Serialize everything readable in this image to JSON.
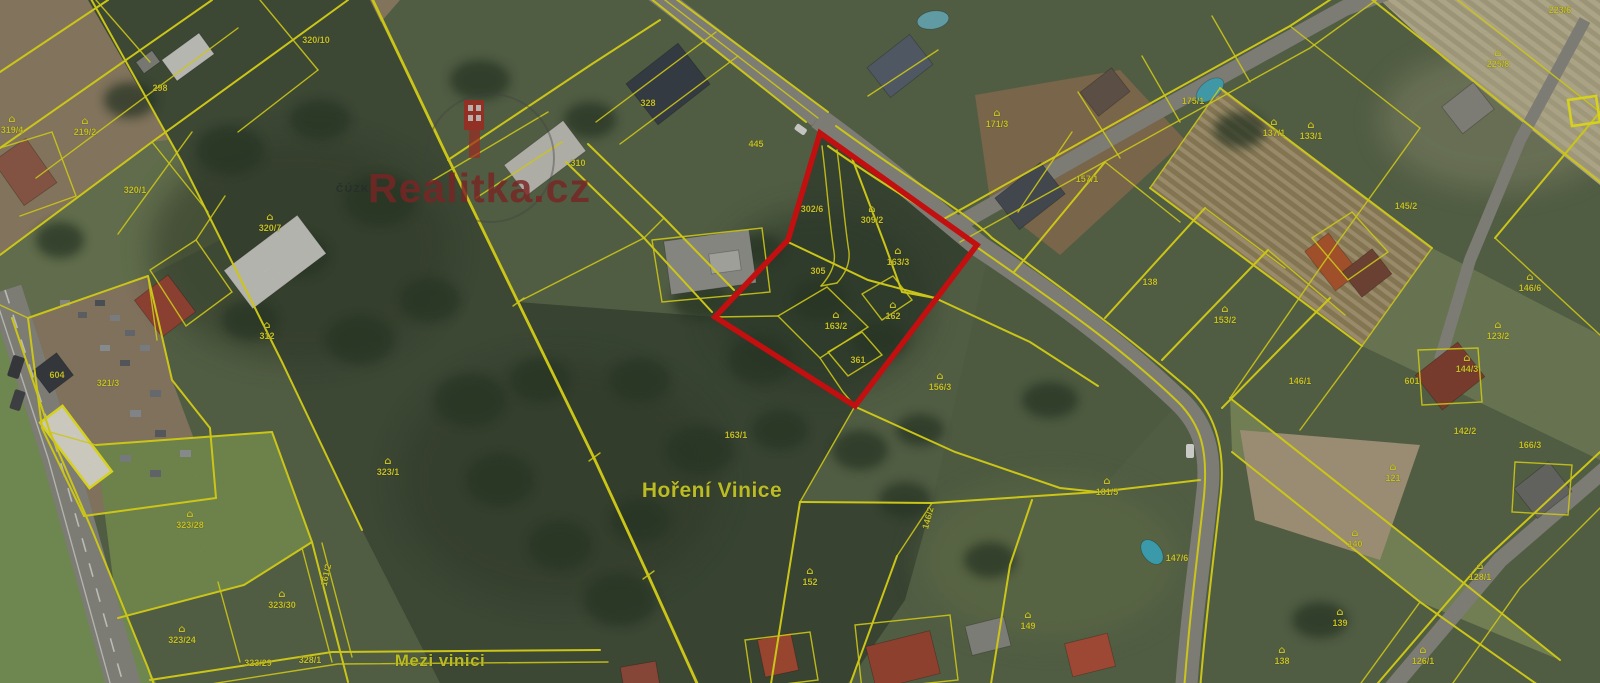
{
  "map": {
    "attribution": "ČÚZK",
    "watermark": {
      "brand": "Realitka.cz"
    },
    "place_labels": [
      {
        "text": "Hoření Vinice",
        "x": 712,
        "y": 497,
        "size": 21
      },
      {
        "text": "Mezi vinici",
        "x": 440,
        "y": 666,
        "size": 17
      }
    ],
    "colors": {
      "boundary": "#ebe41c",
      "highlight": "#e01212",
      "label": "#e3dc2c",
      "watermark": "#8d2b2b",
      "road": "#8f8f88"
    },
    "highlighted_parcel": {
      "description": "Parcel group outlined in red",
      "parcels": [
        "302/6",
        "309/2",
        "305",
        "163/3",
        "163/2",
        "361",
        "162"
      ]
    },
    "parcel_labels": [
      {
        "n": "320/10",
        "x": 316,
        "y": 40
      },
      {
        "n": "298",
        "x": 160,
        "y": 88
      },
      {
        "n": "319/4",
        "x": 12,
        "y": 130,
        "icon": true
      },
      {
        "n": "219/2",
        "x": 85,
        "y": 132,
        "icon": true
      },
      {
        "n": "320/1",
        "x": 135,
        "y": 190
      },
      {
        "n": "320/7",
        "x": 270,
        "y": 228,
        "icon": true
      },
      {
        "n": "312",
        "x": 267,
        "y": 336,
        "icon": true
      },
      {
        "n": "321/3",
        "x": 108,
        "y": 383
      },
      {
        "n": "604",
        "x": 57,
        "y": 375
      },
      {
        "n": "323/1",
        "x": 388,
        "y": 472,
        "icon": true
      },
      {
        "n": "323/28",
        "x": 190,
        "y": 525,
        "icon": true
      },
      {
        "n": "323/30",
        "x": 282,
        "y": 605,
        "icon": true
      },
      {
        "n": "323/24",
        "x": 182,
        "y": 640,
        "icon": true
      },
      {
        "n": "323/29",
        "x": 258,
        "y": 663
      },
      {
        "n": "328/1",
        "x": 310,
        "y": 660
      },
      {
        "n": "161/2",
        "x": 326,
        "y": 575,
        "rot": -78
      },
      {
        "n": "328",
        "x": 648,
        "y": 103
      },
      {
        "n": "310",
        "x": 578,
        "y": 163
      },
      {
        "n": "445",
        "x": 756,
        "y": 144
      },
      {
        "n": "302/6",
        "x": 812,
        "y": 209
      },
      {
        "n": "309/2",
        "x": 872,
        "y": 220,
        "icon": true
      },
      {
        "n": "305",
        "x": 818,
        "y": 271
      },
      {
        "n": "163/3",
        "x": 898,
        "y": 262,
        "icon": true
      },
      {
        "n": "163/2",
        "x": 836,
        "y": 326,
        "icon": true
      },
      {
        "n": "361",
        "x": 858,
        "y": 360
      },
      {
        "n": "162",
        "x": 893,
        "y": 316,
        "icon": true
      },
      {
        "n": "156/3",
        "x": 940,
        "y": 387,
        "icon": true
      },
      {
        "n": "163/1",
        "x": 736,
        "y": 435
      },
      {
        "n": "152",
        "x": 810,
        "y": 582,
        "icon": true
      },
      {
        "n": "149",
        "x": 1028,
        "y": 626,
        "icon": true
      },
      {
        "n": "146/2",
        "x": 928,
        "y": 518,
        "rot": -75
      },
      {
        "n": "171/3",
        "x": 997,
        "y": 124,
        "icon": true
      },
      {
        "n": "157/1",
        "x": 1087,
        "y": 179
      },
      {
        "n": "175/1",
        "x": 1193,
        "y": 101
      },
      {
        "n": "137/1",
        "x": 1274,
        "y": 133,
        "icon": true
      },
      {
        "n": "133/1",
        "x": 1311,
        "y": 136,
        "icon": true
      },
      {
        "n": "138",
        "x": 1150,
        "y": 282
      },
      {
        "n": "153/2",
        "x": 1225,
        "y": 320,
        "icon": true
      },
      {
        "n": "145/2",
        "x": 1406,
        "y": 206
      },
      {
        "n": "146/1",
        "x": 1300,
        "y": 381
      },
      {
        "n": "146/6",
        "x": 1530,
        "y": 288,
        "icon": true
      },
      {
        "n": "123/2",
        "x": 1498,
        "y": 336,
        "icon": true
      },
      {
        "n": "144/3",
        "x": 1467,
        "y": 369,
        "icon": true
      },
      {
        "n": "601",
        "x": 1412,
        "y": 381
      },
      {
        "n": "142/2",
        "x": 1465,
        "y": 431
      },
      {
        "n": "166/3",
        "x": 1530,
        "y": 445
      },
      {
        "n": "225/8",
        "x": 1498,
        "y": 64,
        "icon": true
      },
      {
        "n": "223/6",
        "x": 1560,
        "y": 10
      },
      {
        "n": "181/5",
        "x": 1107,
        "y": 492,
        "icon": true
      },
      {
        "n": "147/6",
        "x": 1177,
        "y": 558
      },
      {
        "n": "121",
        "x": 1393,
        "y": 478,
        "icon": true
      },
      {
        "n": "140",
        "x": 1355,
        "y": 544,
        "icon": true
      },
      {
        "n": "139",
        "x": 1340,
        "y": 623,
        "icon": true
      },
      {
        "n": "126/1",
        "x": 1423,
        "y": 661,
        "icon": true
      },
      {
        "n": "128/1",
        "x": 1480,
        "y": 577,
        "icon": true
      },
      {
        "n": "138",
        "x": 1282,
        "y": 661,
        "icon": true
      }
    ]
  }
}
